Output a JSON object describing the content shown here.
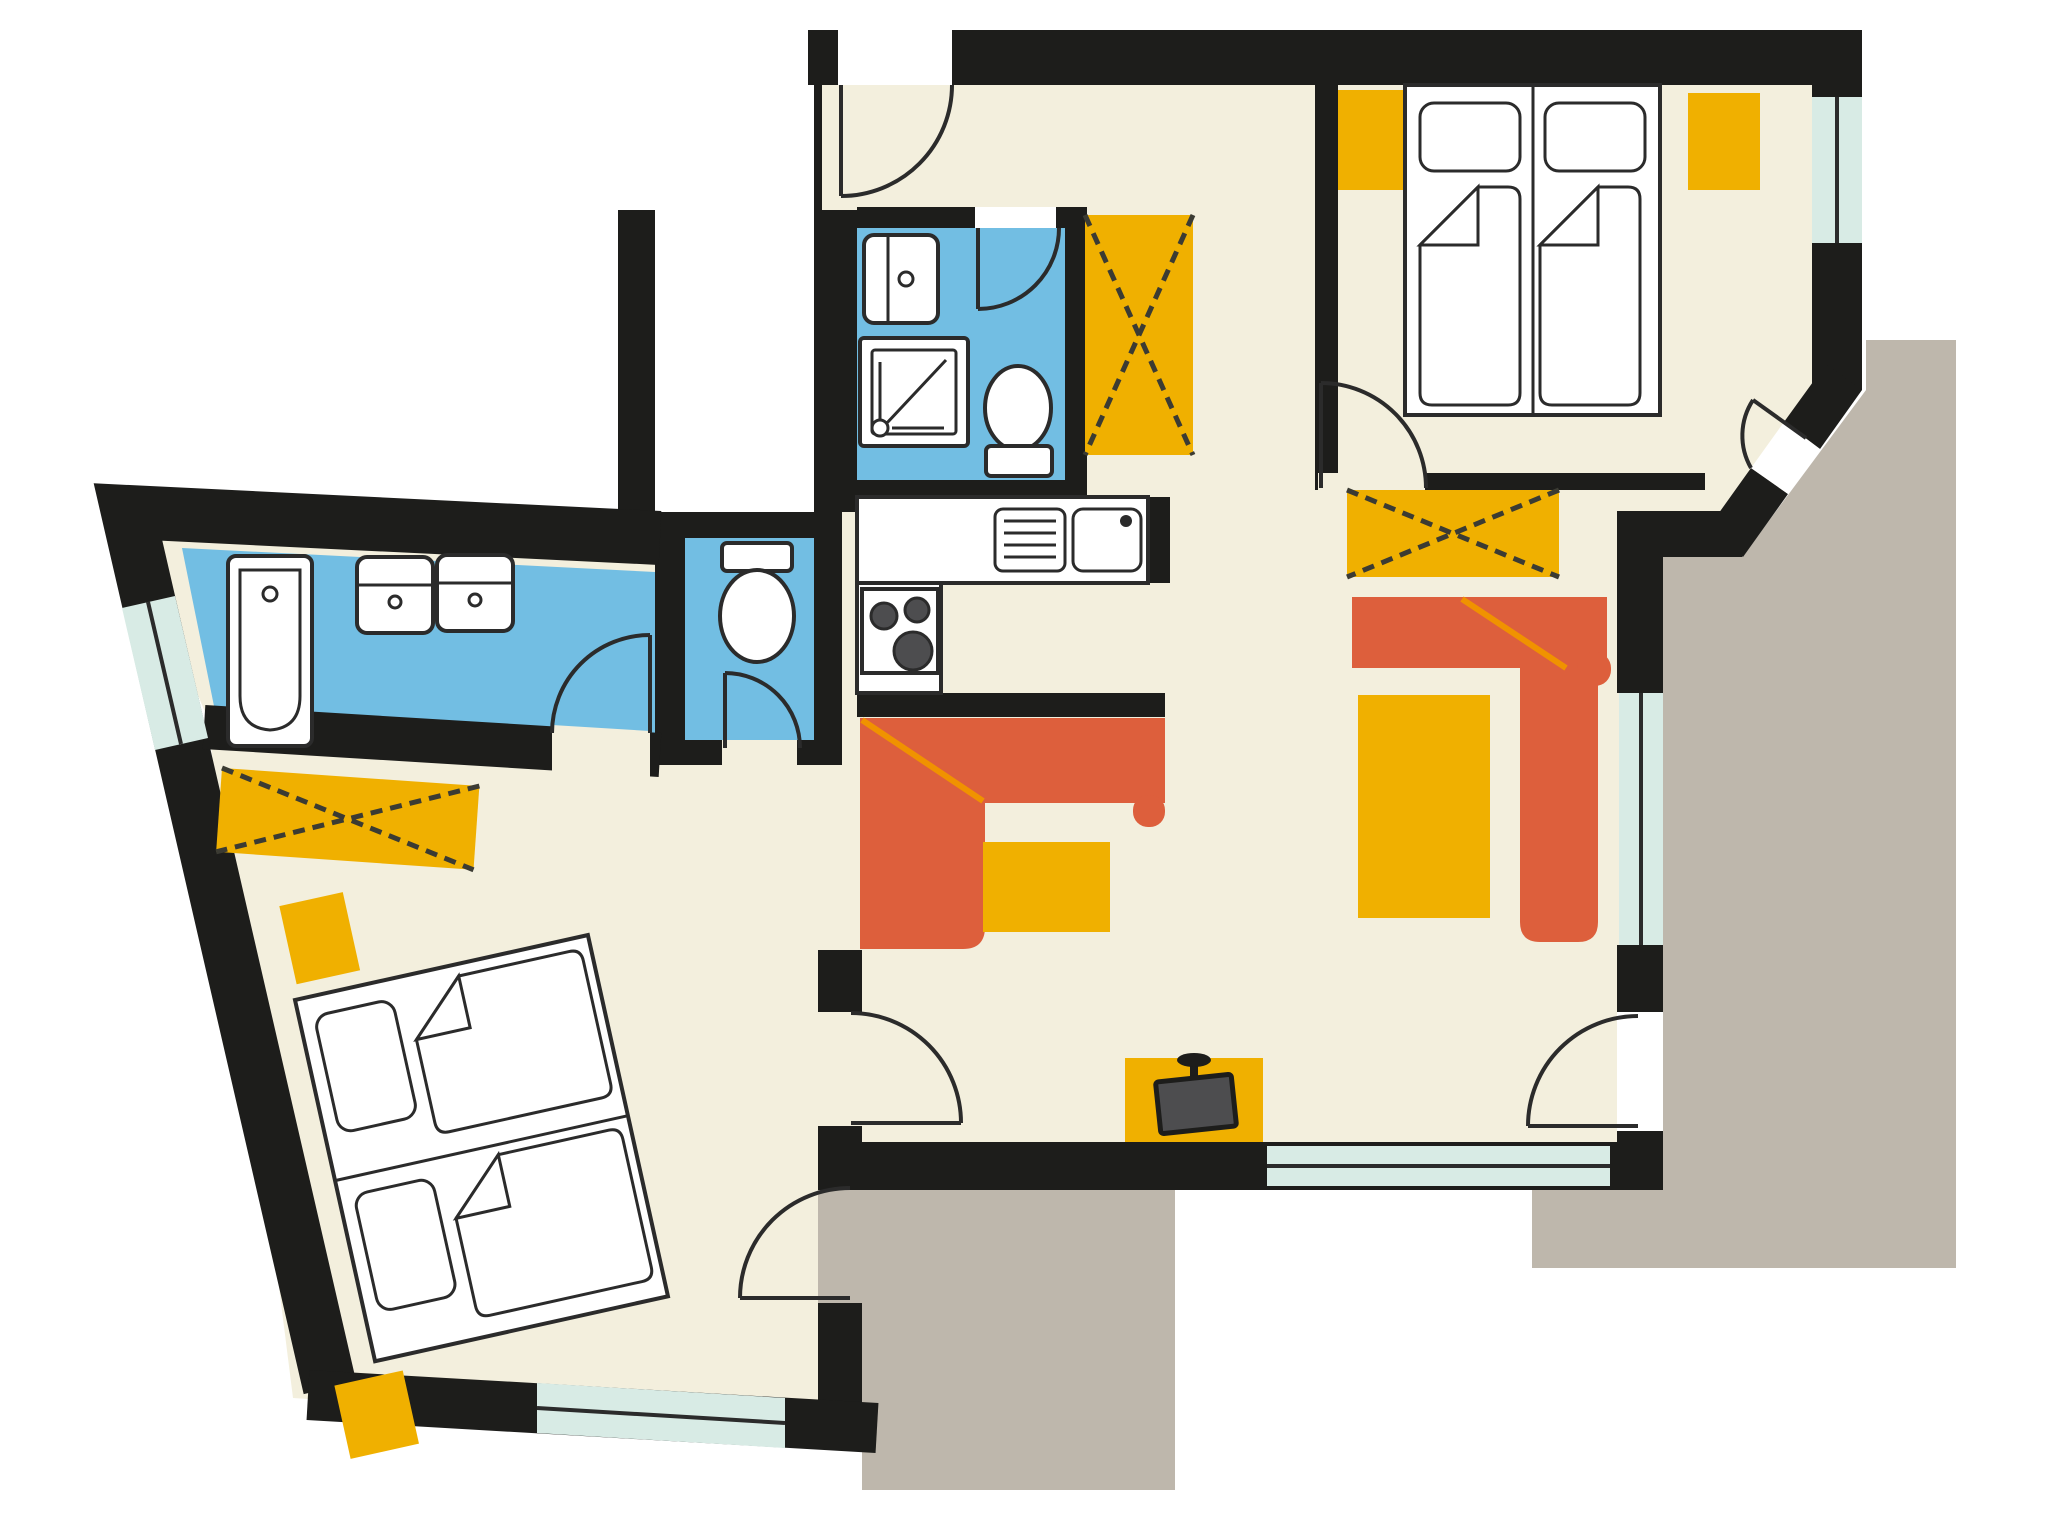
{
  "document": {
    "type": "apartment floor plan",
    "description": "Color floor plan of a two-bedroom apartment with entrance hall, shower room with washing machine, separate WC, bathroom with tub and twin basins, kitchen niche, combined living-dining room and two outdoor terraces",
    "visible_text": []
  },
  "colors": {
    "wall": "#1d1d1b",
    "floor": "#f3efdd",
    "wet": "#72bee3",
    "accent": "#f0b000",
    "sofa": "#dd5f3c",
    "seam": "#f09200",
    "balcony": "#beb7ac",
    "window": "#d8ebe5",
    "outline": "#2b2b2b",
    "xline": "#3b3b33",
    "tv": "#4d4d4f",
    "white": "#ffffff"
  },
  "rooms": [
    {
      "id": "entrance-hall",
      "floor": "floor",
      "features": [
        "entrance-door",
        "tall-wardrobe"
      ]
    },
    {
      "id": "shower-room",
      "floor": "wet",
      "fixtures": [
        "washing-machine",
        "shower",
        "toilet"
      ]
    },
    {
      "id": "wc",
      "floor": "wet",
      "fixtures": [
        "toilet"
      ]
    },
    {
      "id": "bathroom",
      "floor": "wet",
      "fixtures": [
        "bathtub",
        "washbasin",
        "washbasin"
      ],
      "window": true
    },
    {
      "id": "kitchen",
      "floor": "floor",
      "fixtures": [
        "counter",
        "drainer",
        "sink",
        "stove-3-burners"
      ]
    },
    {
      "id": "living-dining-room",
      "floor": "floor",
      "furniture": [
        "corner-bench",
        "dining-table",
        "corner-sofa",
        "coffee-table",
        "sideboard",
        "tv-on-stand"
      ],
      "windows": 2,
      "balcony_doors": 1
    },
    {
      "id": "bedroom-right",
      "floor": "floor",
      "furniture": [
        "twin-beds",
        "nightstand",
        "nightstand"
      ],
      "window": true,
      "balcony_doors": 1
    },
    {
      "id": "bedroom-left",
      "floor": "floor",
      "furniture": [
        "double-bed",
        "nightstand",
        "nightstand",
        "wardrobe-x"
      ],
      "window": true,
      "balcony_doors": 1
    }
  ],
  "outdoor_areas": [
    {
      "id": "terrace-right",
      "color": "balcony"
    },
    {
      "id": "terrace-bottom",
      "color": "balcony"
    }
  ],
  "counts": {
    "rooms": 8,
    "doors": 9,
    "windows": 5,
    "terraces": 2,
    "beds": 4,
    "wardrobes": 3
  }
}
